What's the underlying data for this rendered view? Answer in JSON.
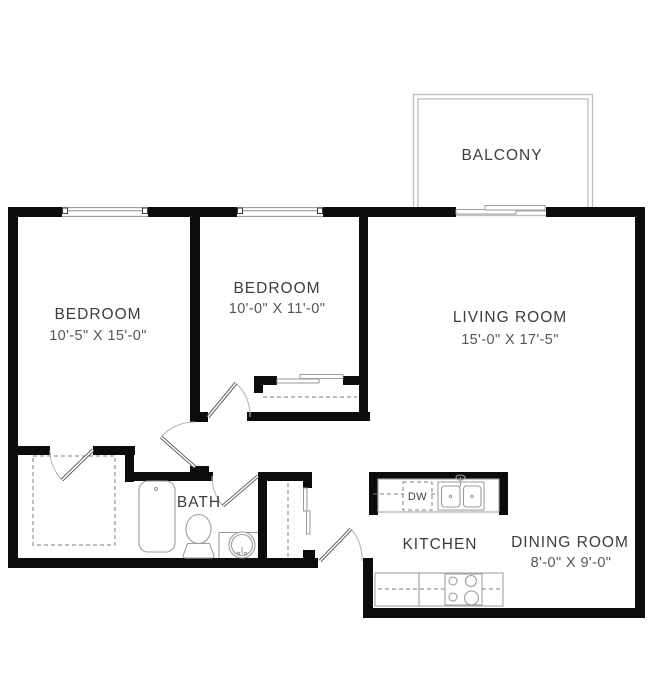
{
  "plan": {
    "colors": {
      "wall": "#0c0c0c",
      "fixture_line": "#9c9c9c",
      "label_text": "#3d3d3d",
      "dims_text": "#565656",
      "balcony_line": "#bdbdbd"
    },
    "rooms": {
      "bedroom1": {
        "label": "BEDROOM",
        "dims": "10'-5\" X 15'-0\""
      },
      "bedroom2": {
        "label": "BEDROOM",
        "dims": "10'-0\" X 11'-0\""
      },
      "living": {
        "label": "LIVING ROOM",
        "dims": "15'-0\" X 17'-5\""
      },
      "dining": {
        "label": "DINING ROOM",
        "dims": "8'-0\" X 9'-0\""
      },
      "kitchen": {
        "label": "KITCHEN"
      },
      "bath": {
        "label": "BATH"
      },
      "balcony": {
        "label": "BALCONY"
      }
    },
    "appliances": {
      "dishwasher": "DW"
    }
  }
}
